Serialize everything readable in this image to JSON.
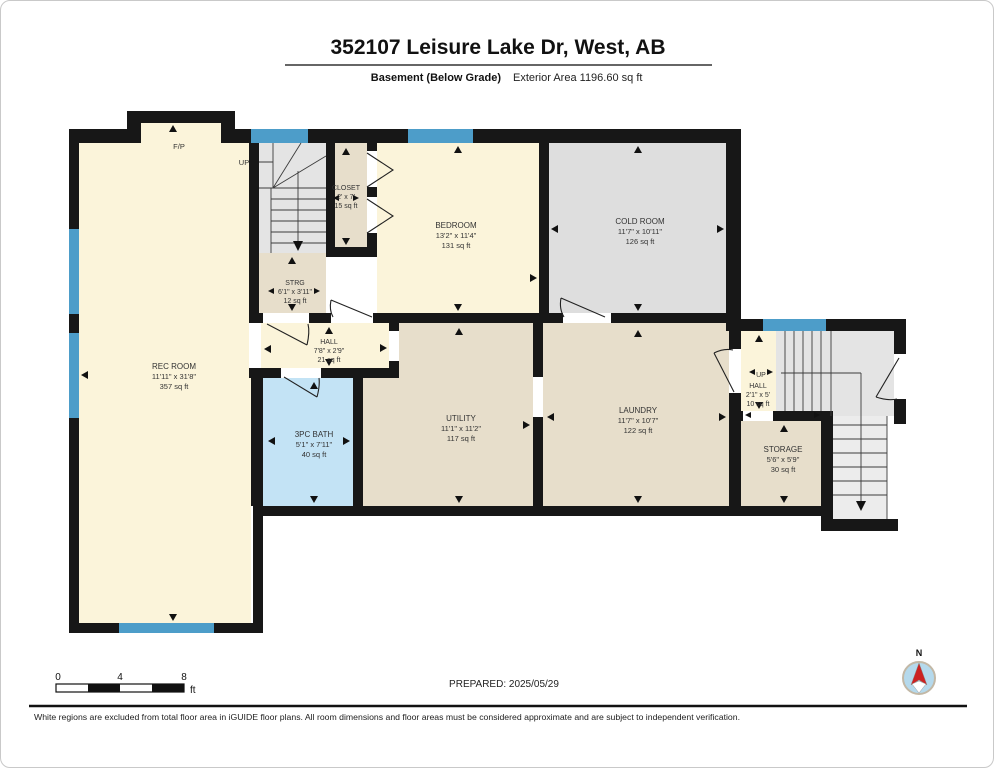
{
  "header": {
    "title": "352107 Leisure Lake Dr, West, AB",
    "floor_label": "Basement (Below Grade)",
    "area_label": "Exterior Area 1196.60 sq ft"
  },
  "rooms": {
    "rec_room": {
      "name": "REC ROOM",
      "dims": "11'11\" x 31'8\"",
      "area": "357 sq ft"
    },
    "closet": {
      "name": "CLOSET",
      "dims": "2' x 7'",
      "area": "15 sq ft"
    },
    "bedroom": {
      "name": "BEDROOM",
      "dims": "13'2\" x 11'4\"",
      "area": "131 sq ft"
    },
    "cold_room": {
      "name": "COLD ROOM",
      "dims": "11'7\" x 10'11\"",
      "area": "126 sq ft"
    },
    "strg": {
      "name": "STRG",
      "dims": "6'1\" x 3'11\"",
      "area": "12 sq ft"
    },
    "hall": {
      "name": "HALL",
      "dims": "7'8\" x 2'9\"",
      "area": "21 sq ft"
    },
    "bath": {
      "name": "3PC BATH",
      "dims": "5'1\" x 7'11\"",
      "area": "40 sq ft"
    },
    "utility": {
      "name": "UTILITY",
      "dims": "11'1\" x 11'2\"",
      "area": "117 sq ft"
    },
    "laundry": {
      "name": "LAUNDRY",
      "dims": "11'7\" x 10'7\"",
      "area": "122 sq ft"
    },
    "hall2": {
      "name": "HALL",
      "dims": "2'1\" x 5'",
      "area": "10 sq ft"
    },
    "storage": {
      "name": "STORAGE",
      "dims": "5'6\" x 5'9\"",
      "area": "30 sq ft"
    }
  },
  "annotations": {
    "fireplace": "F/P",
    "up_main": "UP",
    "up_right": "UP"
  },
  "scale_bar": {
    "tick0": "0",
    "tick4": "4",
    "tick8": "8",
    "unit": "ft"
  },
  "footer": {
    "prepared": "PREPARED: 2025/05/29",
    "disclaimer": "White regions are excluded from total floor area in iGUIDE floor plans. All room dimensions and floor areas must be considered approximate and are subject to independent verification."
  },
  "compass": {
    "label": "N"
  },
  "colors": {
    "room_cream": "#fbf4da",
    "room_tan": "#e7decb",
    "room_gray": "#dedede",
    "bath_blue": "#c3e3f5",
    "window_blue": "#4d9dc9",
    "wall_black": "#171717",
    "compass_red": "#cc2222",
    "compass_blue": "#b5d9ec"
  }
}
